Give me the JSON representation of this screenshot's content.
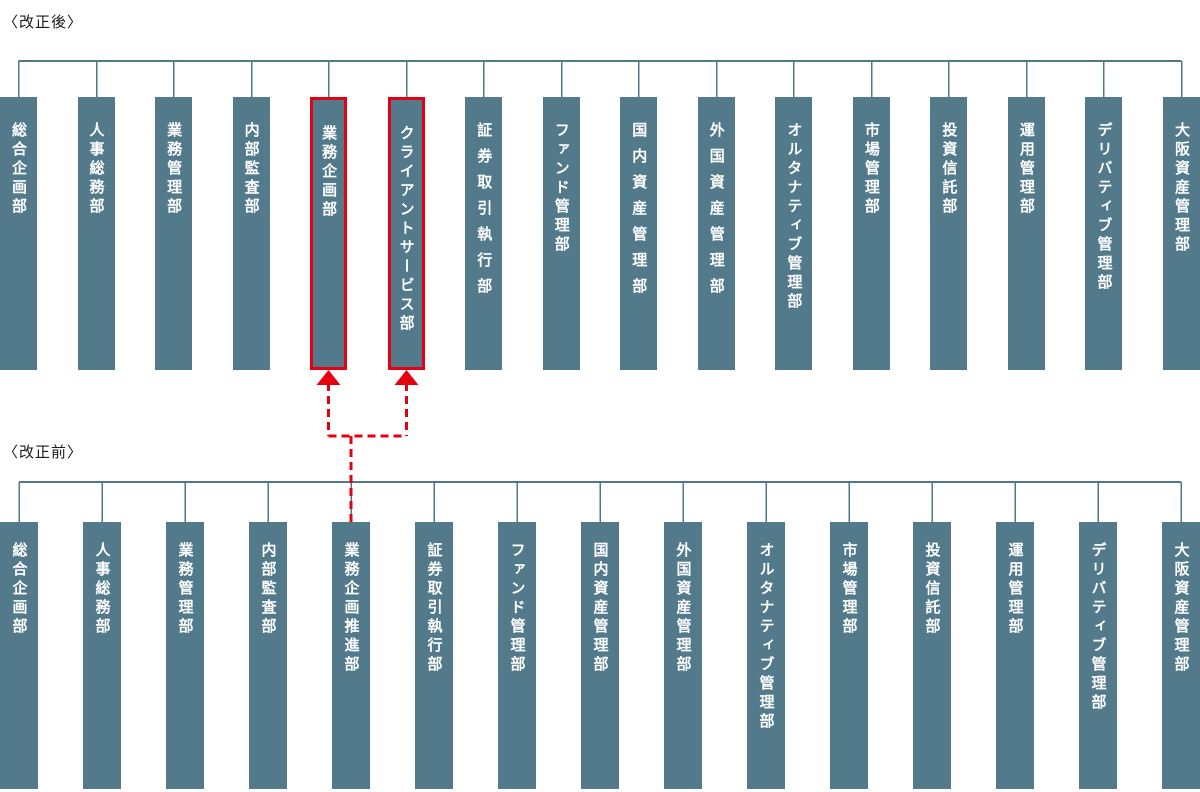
{
  "sections": {
    "after": {
      "label": "〈改正後〉",
      "departments": [
        {
          "name": "総合企画部",
          "highlighted": false,
          "spacing": "normal"
        },
        {
          "name": "人事総務部",
          "highlighted": false,
          "spacing": "normal"
        },
        {
          "name": "業務管理部",
          "highlighted": false,
          "spacing": "normal"
        },
        {
          "name": "内部監査部",
          "highlighted": false,
          "spacing": "normal"
        },
        {
          "name": "業務企画部",
          "highlighted": true,
          "spacing": "normal"
        },
        {
          "name": "クライアントサービス部",
          "highlighted": true,
          "spacing": "normal"
        },
        {
          "name": "証券取引執行部",
          "highlighted": false,
          "spacing": "wide"
        },
        {
          "name": "ファンド管理部",
          "highlighted": false,
          "spacing": "normal"
        },
        {
          "name": "国内資産管理部",
          "highlighted": false,
          "spacing": "wide"
        },
        {
          "name": "外国資産管理部",
          "highlighted": false,
          "spacing": "wide"
        },
        {
          "name": "オルタナティブ管理部",
          "highlighted": false,
          "spacing": "normal"
        },
        {
          "name": "市場管理部",
          "highlighted": false,
          "spacing": "normal"
        },
        {
          "name": "投資信託部",
          "highlighted": false,
          "spacing": "normal"
        },
        {
          "name": "運用管理部",
          "highlighted": false,
          "spacing": "normal"
        },
        {
          "name": "デリバティブ管理部",
          "highlighted": false,
          "spacing": "normal"
        },
        {
          "name": "大阪資産管理部",
          "highlighted": false,
          "spacing": "normal"
        }
      ]
    },
    "before": {
      "label": "〈改正前〉",
      "departments": [
        {
          "name": "総合企画部",
          "highlighted": false,
          "spacing": "normal"
        },
        {
          "name": "人事総務部",
          "highlighted": false,
          "spacing": "normal"
        },
        {
          "name": "業務管理部",
          "highlighted": false,
          "spacing": "normal"
        },
        {
          "name": "内部監査部",
          "highlighted": false,
          "spacing": "normal"
        },
        {
          "name": "業務企画推進部",
          "highlighted": false,
          "spacing": "normal"
        },
        {
          "name": "証券取引執行部",
          "highlighted": false,
          "spacing": "normal"
        },
        {
          "name": "ファンド管理部",
          "highlighted": false,
          "spacing": "normal"
        },
        {
          "name": "国内資産管理部",
          "highlighted": false,
          "spacing": "normal"
        },
        {
          "name": "外国資産管理部",
          "highlighted": false,
          "spacing": "normal"
        },
        {
          "name": "オルタナティブ管理部",
          "highlighted": false,
          "spacing": "normal"
        },
        {
          "name": "市場管理部",
          "highlighted": false,
          "spacing": "normal"
        },
        {
          "name": "投資信託部",
          "highlighted": false,
          "spacing": "normal"
        },
        {
          "name": "運用管理部",
          "highlighted": false,
          "spacing": "normal"
        },
        {
          "name": "デリバティブ管理部",
          "highlighted": false,
          "spacing": "normal"
        },
        {
          "name": "大阪資産管理部",
          "highlighted": false,
          "spacing": "normal"
        }
      ]
    }
  },
  "merge_mapping": {
    "from_before": "業務企画推進部",
    "from_before_index": 4,
    "to_after": [
      "業務企画部",
      "クライアントサービス部"
    ],
    "to_after_indices": [
      4,
      5
    ]
  },
  "colors": {
    "box_fill": "#527a8b",
    "connector_line": "#4f7889",
    "highlight_red": "#e50012",
    "box_text": "#ffffff",
    "label_text": "#1a1a1a"
  }
}
